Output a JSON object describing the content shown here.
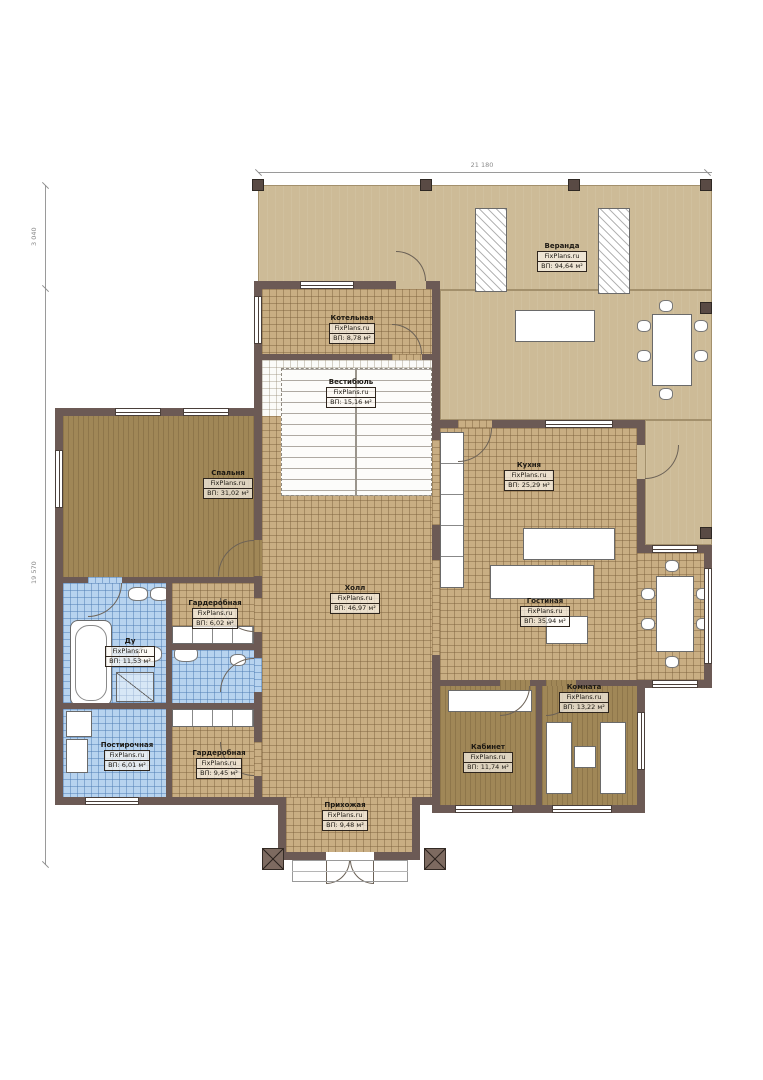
{
  "plan": {
    "brand": "FixPlans.ru",
    "dimensions": {
      "width_top": "21 180",
      "depth_upper": "3 040",
      "depth_lower": "19 570"
    },
    "rooms": {
      "veranda": {
        "name": "Веранда",
        "area": "ВП: 94,64 м²"
      },
      "boiler": {
        "name": "Котельная",
        "area": "ВП: 8,78 м²"
      },
      "vestibule": {
        "name": "Вестибюль",
        "area": "ВП: 15,16 м²"
      },
      "bedroom": {
        "name": "Спальня",
        "area": "ВП: 31,02 м²"
      },
      "kitchen": {
        "name": "Кухня",
        "area": "ВП: 25,29 м²"
      },
      "hall": {
        "name": "Холл",
        "area": "ВП: 46,97 м²"
      },
      "living": {
        "name": "Гостиная",
        "area": "ВП: 35,94 м²"
      },
      "wardrobe_top": {
        "name": "Гардеробная",
        "area": "ВП: 6,02 м²"
      },
      "bath": {
        "name": "Ду",
        "area": "ВП: 11,53 м²"
      },
      "laundry": {
        "name": "Постирочная",
        "area": "ВП: 6,01 м²"
      },
      "wardrobe_bottom": {
        "name": "Гардеробная",
        "area": "ВП: 9,45 м²"
      },
      "office": {
        "name": "Кабинет",
        "area": "ВП: 11,74 м²"
      },
      "room": {
        "name": "Комната",
        "area": "ВП: 13,22 м²"
      },
      "entry": {
        "name": "Прихожая",
        "area": "ВП: 9,48 м²"
      }
    },
    "colors": {
      "wall": "#6c5a55",
      "deck": "#cdbb97",
      "tile": "#c9ae83",
      "wet_tile": "#b7d3ef",
      "wood": "#a08757"
    }
  }
}
